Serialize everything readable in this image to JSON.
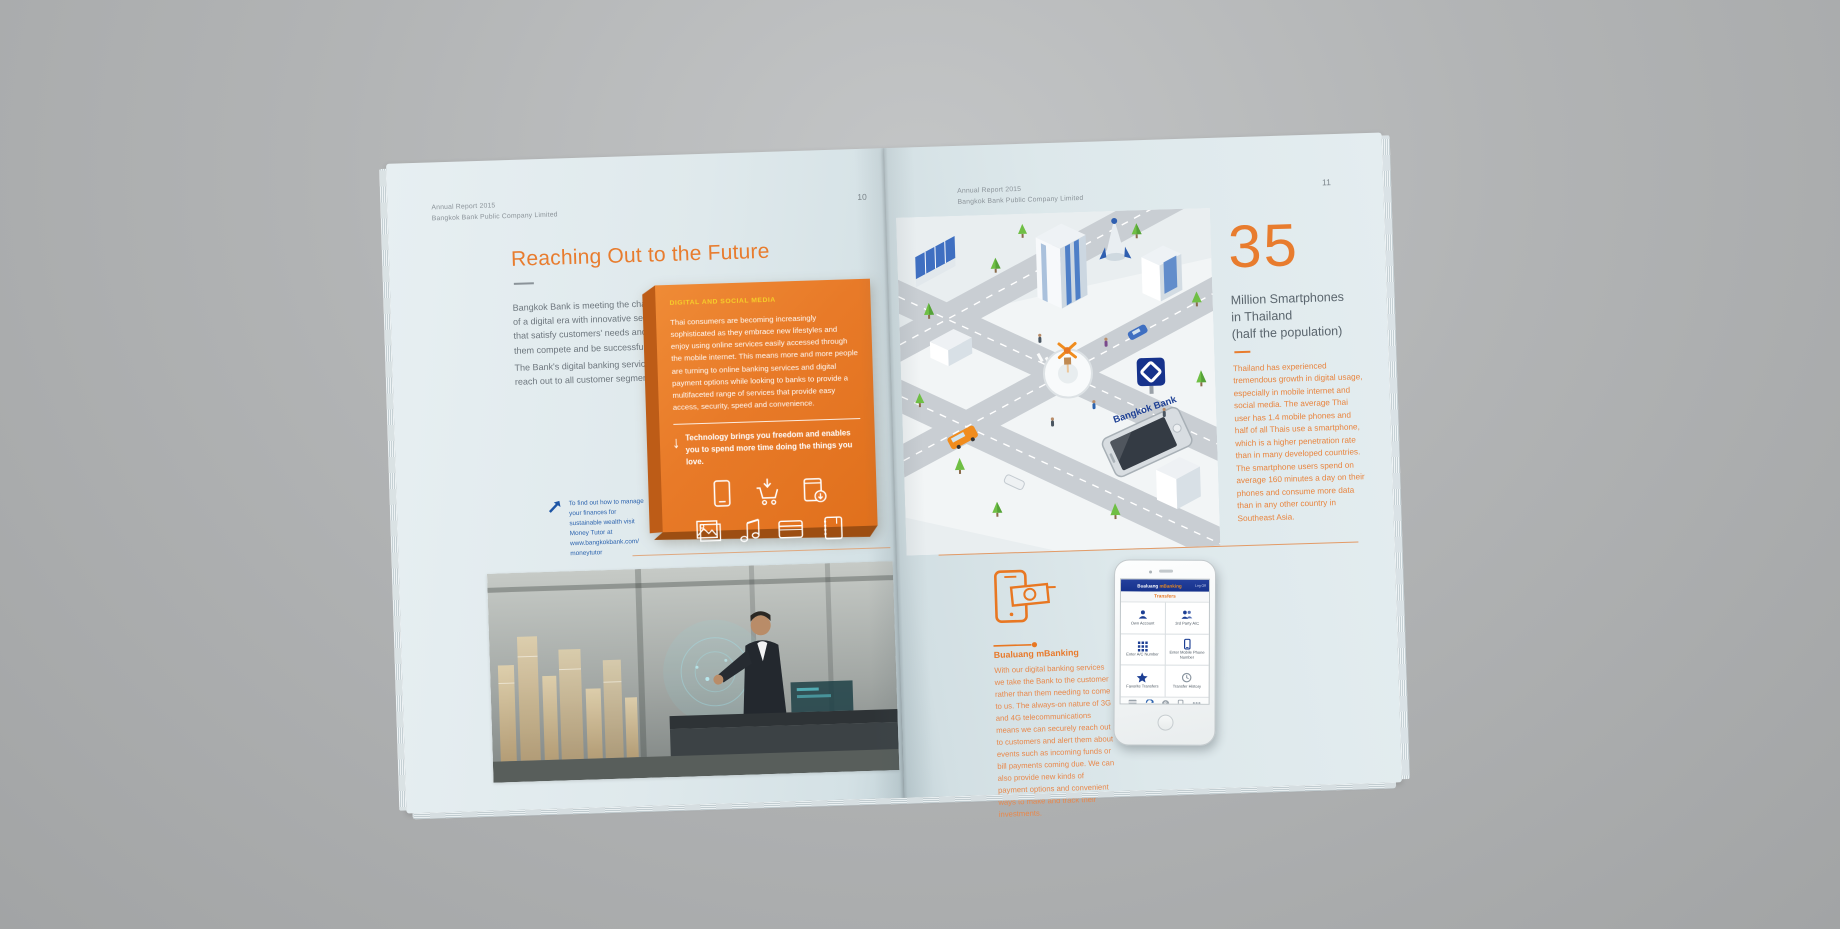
{
  "colors": {
    "accent_orange": "#e87722",
    "paper": "#dde8eb",
    "background_gray": "#b2b4b5",
    "brand_blue": "#16328c",
    "note_blue": "#2c63ae",
    "label_yellow": "#f6cf2a"
  },
  "left_page": {
    "header_line1": "Annual Report 2015",
    "header_line2": "Bangkok Bank Public Company Limited",
    "page_number": "10",
    "title": "Reaching Out to the Future",
    "intro_p1": "Bangkok Bank is meeting the challenges of a digital era with innovative services that satisfy customers' needs and help them compete and be successful.",
    "intro_p2": "The Bank's digital banking services reach out to all customer segments.",
    "orange_box": {
      "label": "DIGITAL AND SOCIAL MEDIA",
      "body": "Thai consumers are becoming increasingly sophisticated as they embrace new lifestyles and enjoy using online services easily accessed through the mobile internet. This means more and more people are turning to online banking services and digital payment options while looking to banks to provide a multifaceted range of services that provide easy access, security, speed and convenience.",
      "quote": "Technology brings you freedom and enables you to spend more time doing the things you love.",
      "icons_row1": [
        "tablet-icon",
        "shopping-cart-download-icon",
        "package-download-icon"
      ],
      "icons_row2": [
        "photos-icon",
        "music-note-icon",
        "credit-card-icon",
        "notebook-icon"
      ]
    },
    "note": "To find out how to manage your finances for sustainable wealth visit Money Tutor at www.bangkokbank.com/ moneytutor",
    "photo_caption": ""
  },
  "right_page": {
    "header_line1": "Annual Report 2015",
    "header_line2": "Bangkok Bank Public Company Limited",
    "page_number": "11",
    "illustration": {
      "brand": "Bangkok Bank"
    },
    "stat": {
      "number": "35",
      "label_line1": "Million Smartphones",
      "label_line2": "in Thailand",
      "label_line3": "(half the population)",
      "body": "Thailand has experienced tremendous growth in digital usage, especially in mobile internet and social media. The average Thai user has 1.4 mobile phones and half of all Thais use a smartphone, which is a higher penetration rate than in many developed countries. The smartphone users spend on average 160 minutes a day on their phones and consume more data than in any other country in Southeast Asia."
    },
    "mbanking": {
      "title": "Bualuang mBanking",
      "body": "With our digital banking services we take the Bank to the customer rather than them needing to come to us. The always-on nature of 3G and 4G telecommunications means we can securely reach out to customers and alert them about events such as incoming funds or bill payments coming due. We can also provide new kinds of payment options and convenient ways to make and track their investments.",
      "icon": "phone-banknote-icon"
    },
    "phone_app": {
      "brand_white": "Bualuang",
      "brand_orange": "mBanking",
      "header_action": "Log Off",
      "screen_title": "Transfers",
      "grid": [
        {
          "icon": "person-icon",
          "label": "Own Account"
        },
        {
          "icon": "people-icon",
          "label": "3rd Party A/C"
        },
        {
          "icon": "keypad-icon",
          "label": "Enter A/C Number"
        },
        {
          "icon": "mobile-icon",
          "label": "Enter Mobile Phone Number"
        },
        {
          "icon": "star-icon",
          "label": "Favorite Transfers"
        },
        {
          "icon": "history-icon",
          "label": "Transfer History"
        }
      ],
      "tab_icons": [
        "accounts-icon",
        "transfer-icon",
        "payments-icon",
        "topup-icon",
        "more-icon"
      ]
    }
  }
}
